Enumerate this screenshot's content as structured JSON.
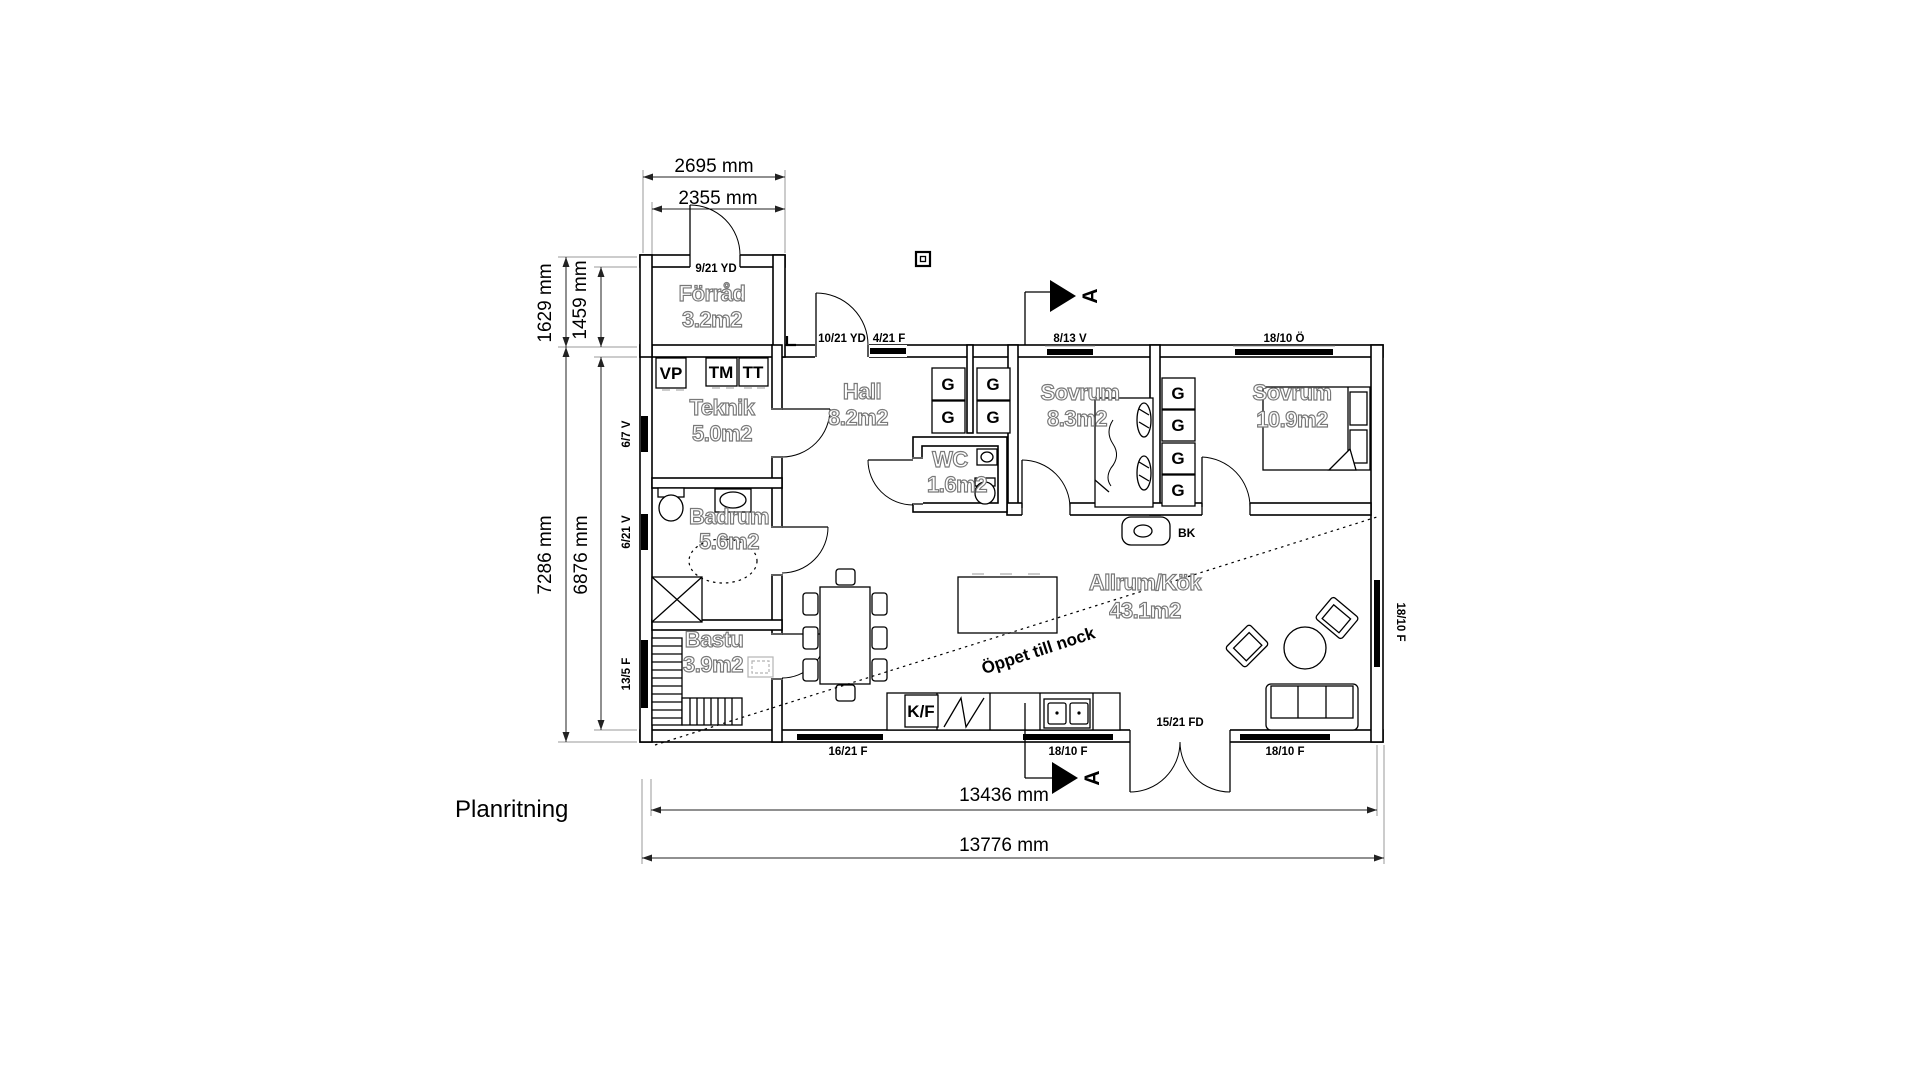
{
  "title": "Planritning",
  "section_marker": "A",
  "rooms": {
    "forrad": {
      "name": "Förråd",
      "area": "3.2m2"
    },
    "teknik": {
      "name": "Teknik",
      "area": "5.0m2"
    },
    "hall": {
      "name": "Hall",
      "area": "8.2m2"
    },
    "wc": {
      "name": "WC",
      "area": "1.6m2"
    },
    "sovrum1": {
      "name": "Sovrum",
      "area": "8.3m2"
    },
    "sovrum2": {
      "name": "Sovrum",
      "area": "10.9m2"
    },
    "badrum": {
      "name": "Badrum",
      "area": "5.6m2"
    },
    "bastu": {
      "name": "Bastu",
      "area": "3.9m2"
    },
    "allrum": {
      "name": "Allrum/Kök",
      "area": "43.1m2"
    }
  },
  "openings": {
    "storage_door": "9/21 YD",
    "entry_door": "10/21 YD",
    "entry_window": "4/21 F",
    "sovrum1_window": "8/13 V",
    "sovrum2_window": "18/10 Ö",
    "teknik_window": "6/7 V",
    "badrum_window": "6/21 V",
    "bastu_window": "13/5 F",
    "dining_window": "16/21 F",
    "kitchen_window": "18/10 F",
    "terrace_door": "15/21 FD",
    "sofa_window": "18/10 F",
    "east_window": "18/10 F"
  },
  "fixtures": {
    "heat_pump": "VP",
    "washing_machine": "TM",
    "dryer": "TT",
    "fridge_freezer": "K/F",
    "wardrobe": "G",
    "fireplace": "BK"
  },
  "annotations": {
    "open_ridge": "Öppet till nock"
  },
  "dimensions": {
    "annex_outer_width": "2695 mm",
    "annex_inner_width": "2355 mm",
    "annex_outer_depth": "1629 mm",
    "annex_inner_depth": "1459 mm",
    "house_outer_depth": "7286 mm",
    "house_inner_depth": "6876 mm",
    "house_inner_width": "13436 mm",
    "house_outer_width": "13776 mm"
  }
}
